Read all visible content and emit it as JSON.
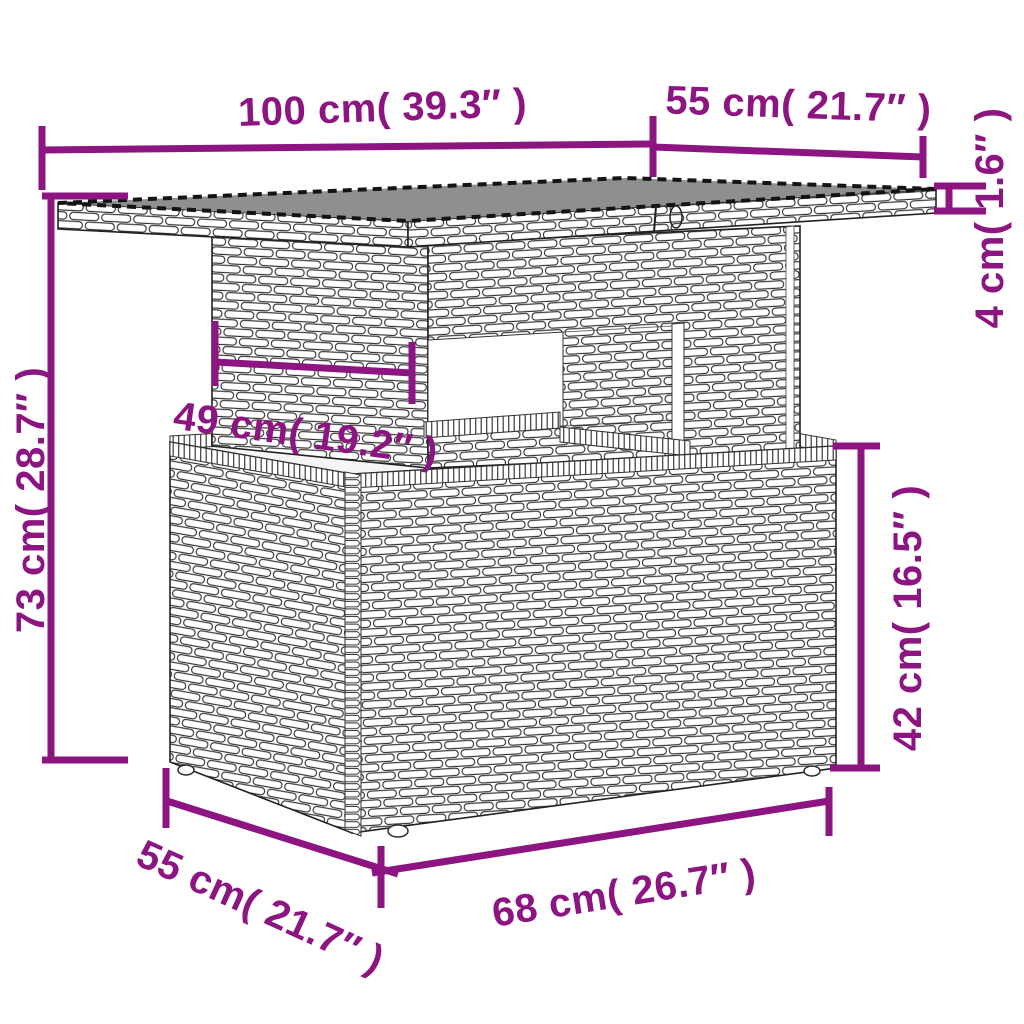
{
  "diagram": {
    "accent_color": "#8D1581",
    "dimensions": {
      "top_width": "100 cm( 39.3″ )",
      "top_depth": "55 cm( 21.7″ )",
      "top_thickness": "4 cm( 1.6″ )",
      "overall_height": "73 cm( 28.7″ )",
      "pedestal_width": "49 cm( 19.2″ )",
      "base_height": "42 cm( 16.5″ )",
      "base_depth": "55 cm( 21.7″ )",
      "base_width": "68 cm( 26.7″ )"
    }
  }
}
